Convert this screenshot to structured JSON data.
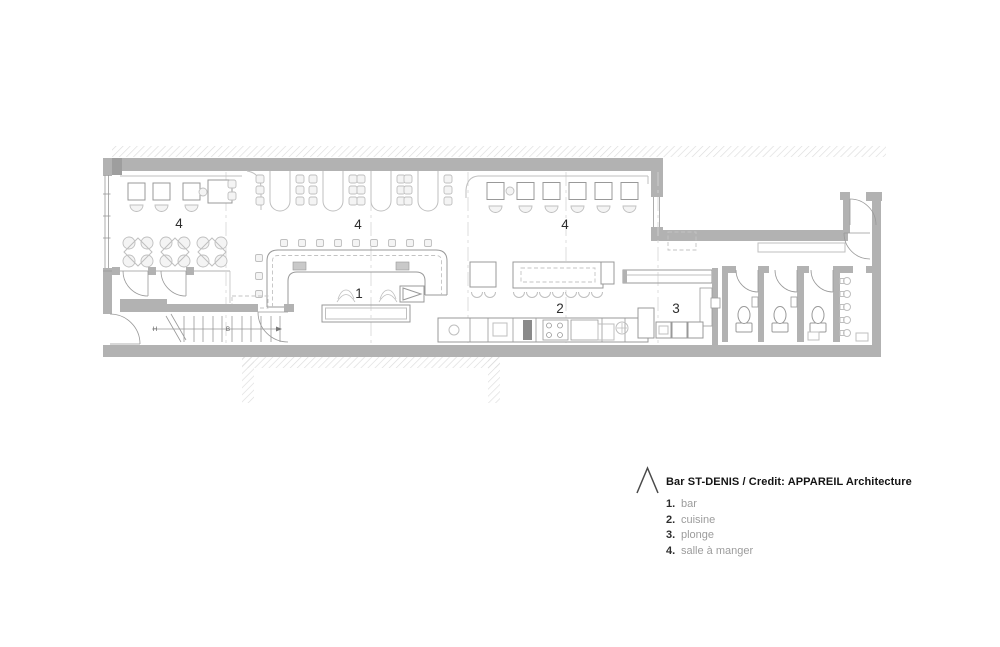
{
  "legend": {
    "title": "Bar ST-DENIS / Credit: APPAREIL Architecture",
    "items": [
      {
        "number": "1.",
        "label": "bar"
      },
      {
        "number": "2.",
        "label": "cuisine"
      },
      {
        "number": "3.",
        "label": "plonge"
      },
      {
        "number": "4.",
        "label": "salle à manger"
      }
    ]
  },
  "plan": {
    "room_labels": [
      {
        "id": "salle-a-manger-west",
        "text": "4"
      },
      {
        "id": "salle-a-manger-center",
        "text": "4"
      },
      {
        "id": "salle-a-manger-east",
        "text": "4"
      },
      {
        "id": "bar",
        "text": "1"
      },
      {
        "id": "cuisine",
        "text": "2"
      },
      {
        "id": "plonge",
        "text": "3"
      }
    ],
    "stairs": {
      "up": "H",
      "down": "B"
    },
    "colors": {
      "wall": "#b2b2b2",
      "wall_dark": "#9e9e9e",
      "line": "#999999",
      "light_line": "#bfbfbf",
      "hatch": "#dcdcdc",
      "label": "#2d2d2d",
      "legend_label": "#9c9c9c",
      "title": "#141414"
    }
  }
}
